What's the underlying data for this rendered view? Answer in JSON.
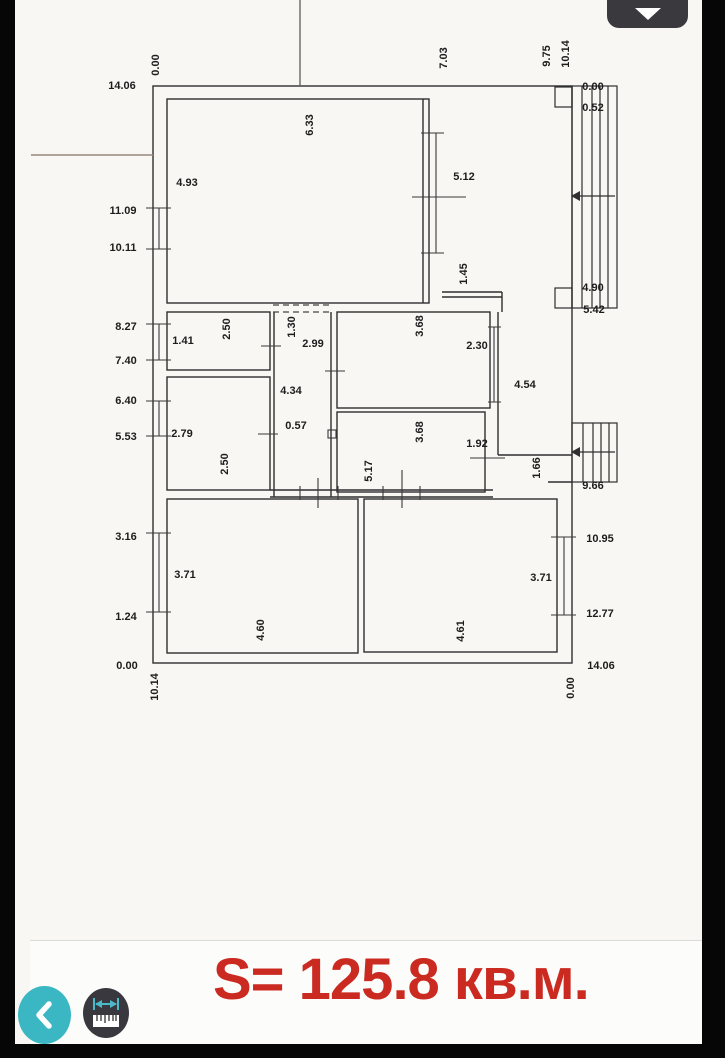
{
  "ui": {
    "area_label": "S= 125.8 кв.м.",
    "colors": {
      "area_red": "#cb2a21",
      "accent_teal": "#3bb7c4",
      "button_dark": "#39383e"
    },
    "buttons": {
      "back": "chevron-left",
      "measure": "ruler",
      "collapse": "chevron-down"
    }
  },
  "plan": {
    "units": "m",
    "total_width_m": "10.14",
    "total_height_m": "14.06",
    "chainage_left": [
      "14.06",
      "11.09",
      "10.11",
      "8.27",
      "7.40",
      "6.40",
      "5.53",
      "3.16",
      "1.24",
      "0.00"
    ],
    "chainage_right": [
      "0.00",
      "0.52",
      "4.90",
      "5.42",
      "9.66",
      "10.95",
      "12.77",
      "14.06"
    ],
    "chainage_top": [
      "0.00",
      "7.03",
      "9.75",
      "10.14"
    ],
    "chainage_bottom": [
      "10.14",
      "0.00"
    ],
    "labels": [
      {
        "t": "14.06",
        "x": 107,
        "y": 86,
        "r": 0
      },
      {
        "t": "11.09",
        "x": 108,
        "y": 211,
        "r": 0
      },
      {
        "t": "10.11",
        "x": 108,
        "y": 248,
        "r": 0
      },
      {
        "t": "8.27",
        "x": 111,
        "y": 327,
        "r": 0
      },
      {
        "t": "7.40",
        "x": 111,
        "y": 361,
        "r": 0
      },
      {
        "t": "6.40",
        "x": 111,
        "y": 401,
        "r": 0
      },
      {
        "t": "5.53",
        "x": 111,
        "y": 437,
        "r": 0
      },
      {
        "t": "3.16",
        "x": 111,
        "y": 537,
        "r": 0
      },
      {
        "t": "1.24",
        "x": 111,
        "y": 617,
        "r": 0
      },
      {
        "t": "0.00",
        "x": 112,
        "y": 666,
        "r": 0
      },
      {
        "t": "0.00",
        "x": 578,
        "y": 87,
        "r": 0
      },
      {
        "t": "0.52",
        "x": 578,
        "y": 108,
        "r": 0
      },
      {
        "t": "4.90",
        "x": 578,
        "y": 288,
        "r": 0
      },
      {
        "t": "5.42",
        "x": 579,
        "y": 310,
        "r": 0
      },
      {
        "t": "9.66",
        "x": 578,
        "y": 486,
        "r": 0
      },
      {
        "t": "10.95",
        "x": 585,
        "y": 539,
        "r": 0
      },
      {
        "t": "12.77",
        "x": 585,
        "y": 614,
        "r": 0
      },
      {
        "t": "14.06",
        "x": 586,
        "y": 666,
        "r": 0
      },
      {
        "t": "0.00",
        "x": 141,
        "y": 65,
        "r": 1
      },
      {
        "t": "7.03",
        "x": 429,
        "y": 58,
        "r": 1
      },
      {
        "t": "9.75",
        "x": 532,
        "y": 56,
        "r": 1
      },
      {
        "t": "10.14",
        "x": 551,
        "y": 54,
        "r": 1
      },
      {
        "t": "10.14",
        "x": 140,
        "y": 687,
        "r": 1
      },
      {
        "t": "0.00",
        "x": 556,
        "y": 688,
        "r": 1
      },
      {
        "t": "4.93",
        "x": 172,
        "y": 183,
        "r": 0
      },
      {
        "t": "6.33",
        "x": 295,
        "y": 125,
        "r": 1
      },
      {
        "t": "5.12",
        "x": 449,
        "y": 177,
        "r": 0
      },
      {
        "t": "1.45",
        "x": 449,
        "y": 274,
        "r": 1
      },
      {
        "t": "1.41",
        "x": 168,
        "y": 341,
        "r": 0
      },
      {
        "t": "2.50",
        "x": 212,
        "y": 329,
        "r": 1
      },
      {
        "t": "1.30",
        "x": 277,
        "y": 327,
        "r": 1
      },
      {
        "t": "2.99",
        "x": 298,
        "y": 344,
        "r": 0
      },
      {
        "t": "3.68",
        "x": 405,
        "y": 326,
        "r": 1
      },
      {
        "t": "2.30",
        "x": 462,
        "y": 346,
        "r": 0
      },
      {
        "t": "4.34",
        "x": 276,
        "y": 391,
        "r": 0
      },
      {
        "t": "4.54",
        "x": 510,
        "y": 385,
        "r": 0
      },
      {
        "t": "2.79",
        "x": 167,
        "y": 434,
        "r": 0
      },
      {
        "t": "2.50",
        "x": 210,
        "y": 464,
        "r": 1
      },
      {
        "t": "0.57",
        "x": 281,
        "y": 426,
        "r": 0
      },
      {
        "t": "3.68",
        "x": 405,
        "y": 432,
        "r": 1
      },
      {
        "t": "1.92",
        "x": 462,
        "y": 444,
        "r": 0
      },
      {
        "t": "5.17",
        "x": 354,
        "y": 471,
        "r": 1
      },
      {
        "t": "1.66",
        "x": 522,
        "y": 468,
        "r": 1
      },
      {
        "t": "3.71",
        "x": 170,
        "y": 575,
        "r": 0
      },
      {
        "t": "4.60",
        "x": 246,
        "y": 630,
        "r": 1
      },
      {
        "t": "4.61",
        "x": 446,
        "y": 631,
        "r": 1
      },
      {
        "t": "3.71",
        "x": 526,
        "y": 578,
        "r": 0
      }
    ]
  }
}
